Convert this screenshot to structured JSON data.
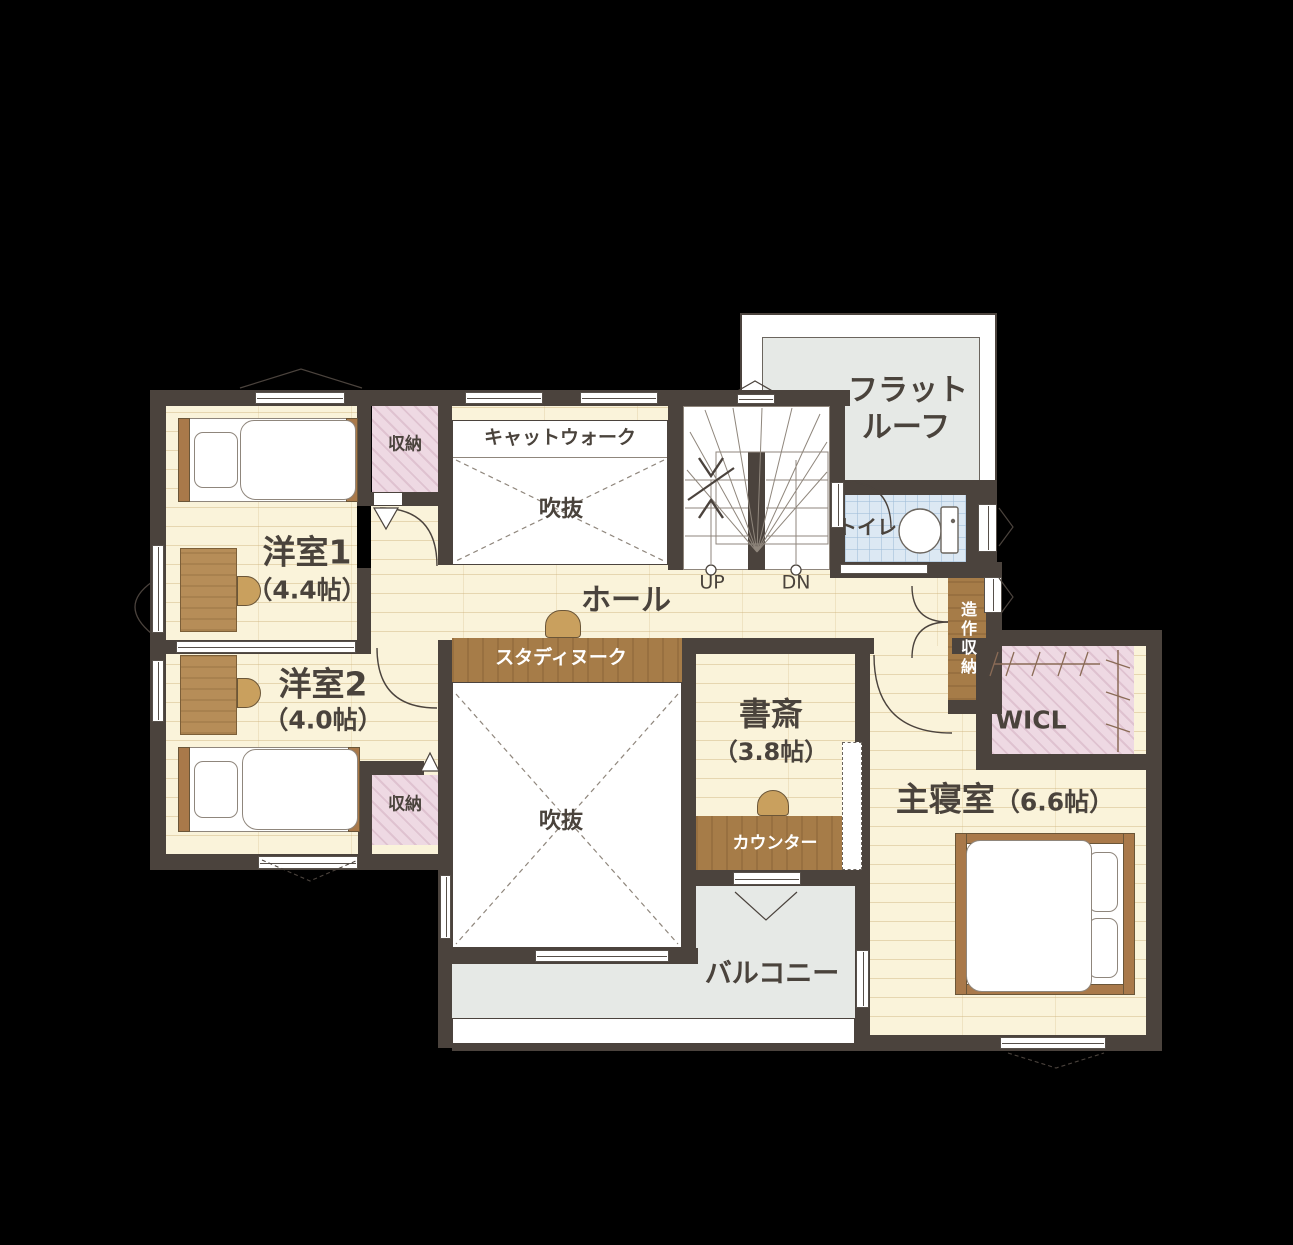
{
  "colors": {
    "bg": "#000000",
    "wall": "#4b433d",
    "floor": "#faf3da",
    "white": "#ffffff",
    "pink": "#eed9e3",
    "tile": "#dce8f3",
    "gray": "#e6e9e6",
    "wood": "#a67c48",
    "desk": "#b68d58",
    "tan": "#c9a05e",
    "line": "#8f867c",
    "text": "#4a433c"
  },
  "labels": {
    "flat_roof_1": "フラット",
    "flat_roof_2": "ルーフ",
    "catwalk": "キャットウォーク",
    "void": "吹抜",
    "storage": "収納",
    "room1_name": "洋室1",
    "room1_size": "（4.4帖）",
    "room2_name": "洋室2",
    "room2_size": "（4.0帖）",
    "hall": "ホール",
    "study_nook": "スタディヌーク",
    "study_name": "書斎",
    "study_size": "（3.8帖）",
    "counter": "カウンター",
    "toilet": "トイレ",
    "builtin_storage": "造作収納",
    "wicl": "WICL",
    "master_name": "主寝室",
    "master_size": "（6.6帖）",
    "balcony": "バルコニー",
    "up": "UP",
    "dn": "DN"
  }
}
